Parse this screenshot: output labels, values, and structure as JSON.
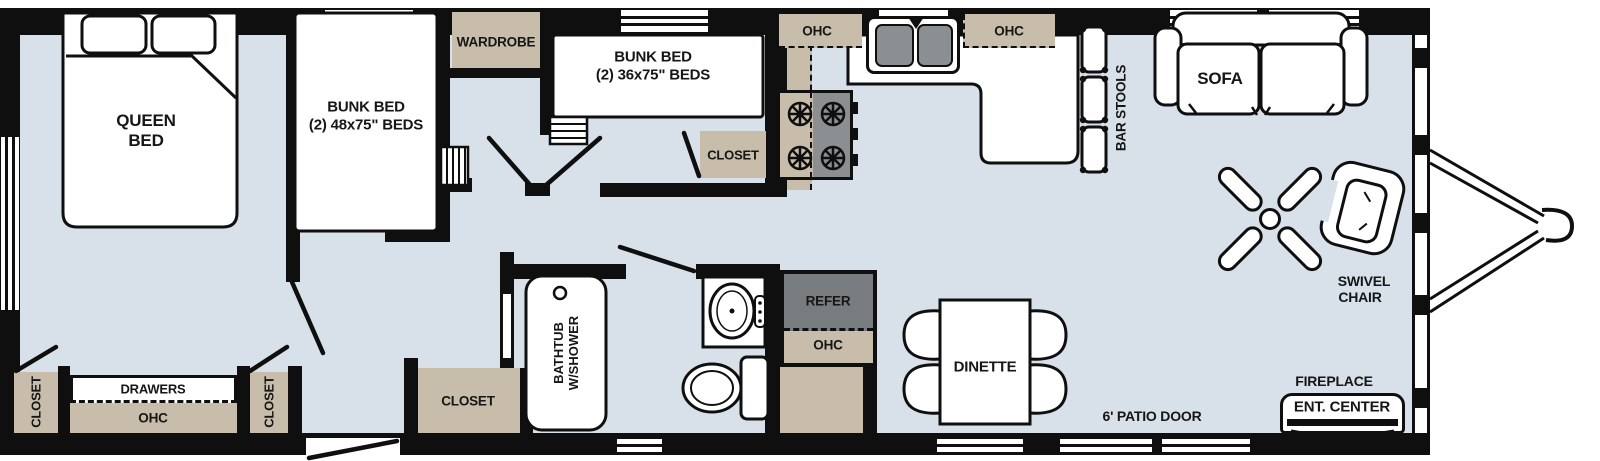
{
  "floorplan": {
    "colors": {
      "floor": "#d8e0ea",
      "cabinet_tan": "#c7bdaa",
      "appliance_gray": "#8c8f91",
      "refer_gray": "#797c7e",
      "wall_black": "#0f0f0f"
    },
    "bedroom": {
      "queen_line1": "QUEEN",
      "queen_line2": "BED",
      "closet_left": "CLOSET",
      "closet_right": "CLOSET",
      "drawers": "DRAWERS",
      "ohc": "OHC"
    },
    "bunkroom48": {
      "line1": "BUNK BED",
      "line2": "(2) 48x75\" BEDS"
    },
    "wardrobe": "WARDROBE",
    "bunkroom36": {
      "line1": "BUNK BED",
      "line2": "(2) 36x75\" BEDS",
      "closet": "CLOSET"
    },
    "bathroom": {
      "bathtub_line1": "BATHTUB",
      "bathtub_line2": "W/SHOWER",
      "closet": "CLOSET"
    },
    "kitchen": {
      "ohc_left": "OHC",
      "ohc_right": "OHC",
      "refer": "REFER",
      "refer_ohc": "OHC"
    },
    "living": {
      "bar_stools": "BAR STOOLS",
      "sofa": "SOFA",
      "swivel_line1": "SWIVEL",
      "swivel_line2": "CHAIR",
      "fireplace": "FIREPLACE",
      "ent_center": "ENT. CENTER",
      "dinette": "DINETTE",
      "patio_door": "6' PATIO DOOR"
    }
  }
}
